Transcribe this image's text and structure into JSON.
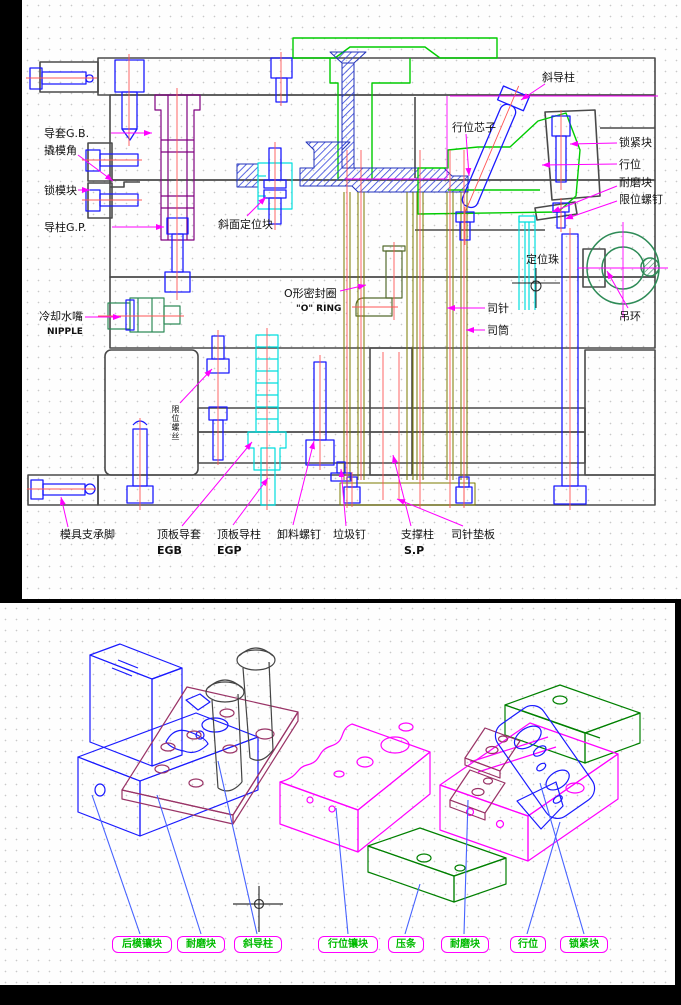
{
  "window": {
    "bg": "#000000",
    "sheet_bg": "#fefefe"
  },
  "palette": {
    "outline_gray": "#4a4a4a",
    "screw_blue": "#1a1aff",
    "centerline_red": "#ff5555",
    "leader_magenta": "#ff00ff",
    "bright_green": "#00cc00",
    "dark_green": "#2e8b57",
    "olive": "#7a7a00",
    "cyan": "#00dede",
    "purple": "#800080",
    "maroon": "#993366",
    "exploded_leader_blue": "#4662ff",
    "box_text_green": "#00bb00"
  },
  "section_view": {
    "labels": {
      "guide_bushing": {
        "text": "导套G.B."
      },
      "pry_corner": {
        "text": "撬模角"
      },
      "mold_lock_block": {
        "text": "锁模块"
      },
      "guide_pillar": {
        "text": "导柱G.P."
      },
      "bevel_locating_block": {
        "text": "斜面定位块"
      },
      "cooling_nozzle": {
        "text": "冷却水嘴",
        "sub": "NIPPLE"
      },
      "o_ring": {
        "text": "O形密封圈",
        "sub": "\"O\" RING"
      },
      "limit_screw_small": {
        "text": "限位螺丝"
      },
      "angled_guide_pillar": {
        "text": "斜导柱"
      },
      "slide_core": {
        "text": "行位芯子"
      },
      "locking_block": {
        "text": "锁紧块"
      },
      "slide": {
        "text": "行位"
      },
      "wear_block": {
        "text": "耐磨块"
      },
      "limit_screw": {
        "text": "限位螺钉"
      },
      "positioning_ball": {
        "text": "定位珠"
      },
      "ejector_sleeve_pin": {
        "text": "司针"
      },
      "ejector_sleeve": {
        "text": "司筒"
      },
      "lifting_ring": {
        "text": "吊环"
      },
      "mold_foot": {
        "text": "模具支承脚"
      },
      "ejector_plate_bushing": {
        "text": "顶板导套",
        "sub": "EGB"
      },
      "ejector_plate_pillar": {
        "text": "顶板导柱",
        "sub": "EGP"
      },
      "stripper_bolt": {
        "text": "卸料螺钉"
      },
      "stop_pin": {
        "text": "垃圾钉"
      },
      "support_pillar": {
        "text": "支撑柱",
        "sub": "S.P"
      },
      "pin_backing_plate": {
        "text": "司针垫板"
      }
    }
  },
  "exploded_view": {
    "boxes": [
      {
        "text": "后模镶块"
      },
      {
        "text": "耐磨块"
      },
      {
        "text": "斜导柱"
      },
      {
        "text": "行位镶块"
      },
      {
        "text": "压条"
      },
      {
        "text": "耐磨块"
      },
      {
        "text": "行位"
      },
      {
        "text": "锁紧块"
      }
    ]
  }
}
